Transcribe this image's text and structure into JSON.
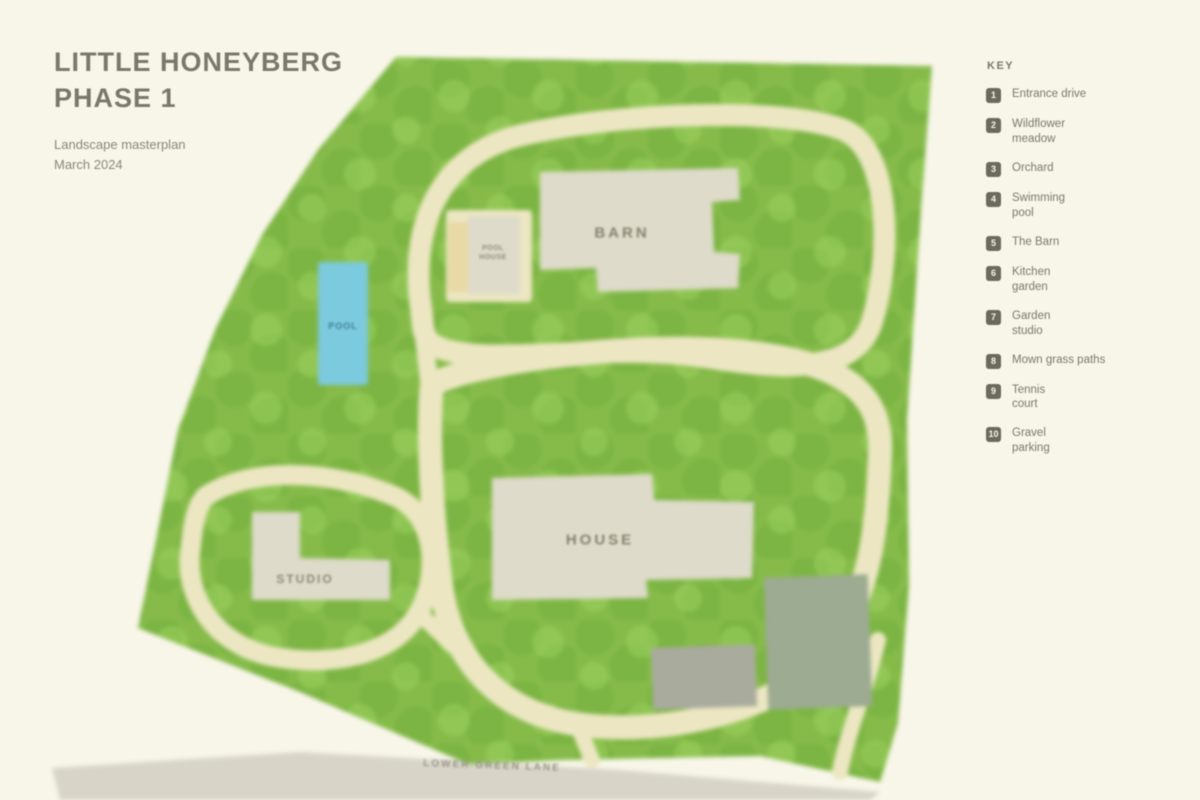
{
  "title": {
    "line1": "LITTLE HONEYBERG",
    "line2": "PHASE 1"
  },
  "subtitle": {
    "line1": "Landscape masterplan",
    "line2": "March 2024"
  },
  "legend": {
    "heading": "KEY",
    "items": [
      {
        "num": "1",
        "label": "Entrance drive"
      },
      {
        "num": "2",
        "label": "Wildflower\nmeadow"
      },
      {
        "num": "3",
        "label": "Orchard"
      },
      {
        "num": "4",
        "label": "Swimming\npool"
      },
      {
        "num": "5",
        "label": "The Barn"
      },
      {
        "num": "6",
        "label": "Kitchen\ngarden"
      },
      {
        "num": "7",
        "label": "Garden\nstudio"
      },
      {
        "num": "8",
        "label": "Mown grass paths"
      },
      {
        "num": "9",
        "label": "Tennis\ncourt"
      },
      {
        "num": "10",
        "label": "Gravel\nparking"
      }
    ]
  },
  "map_labels": {
    "barn": "BARN",
    "house": "HOUSE",
    "studio": "STUDIO",
    "pool": "POOL",
    "pool_house": "POOL\nHOUSE",
    "road": "LOWER GREEN LANE"
  },
  "colors": {
    "background": "#f8f6e9",
    "green_base": "#86bb4a",
    "green_canopy_dark": "#6fae3a",
    "green_canopy_light": "#9ed35f",
    "path_cream": "#ece7c2",
    "pool_blue": "#7ccadd",
    "building_grey": "#dedbca",
    "road_grey": "#d8d5c8",
    "court_grey_green": "#9cab92",
    "parking_grey": "#a9ab9d",
    "deck_tan": "#e9d9a5",
    "text_grey": "#7c7869"
  }
}
